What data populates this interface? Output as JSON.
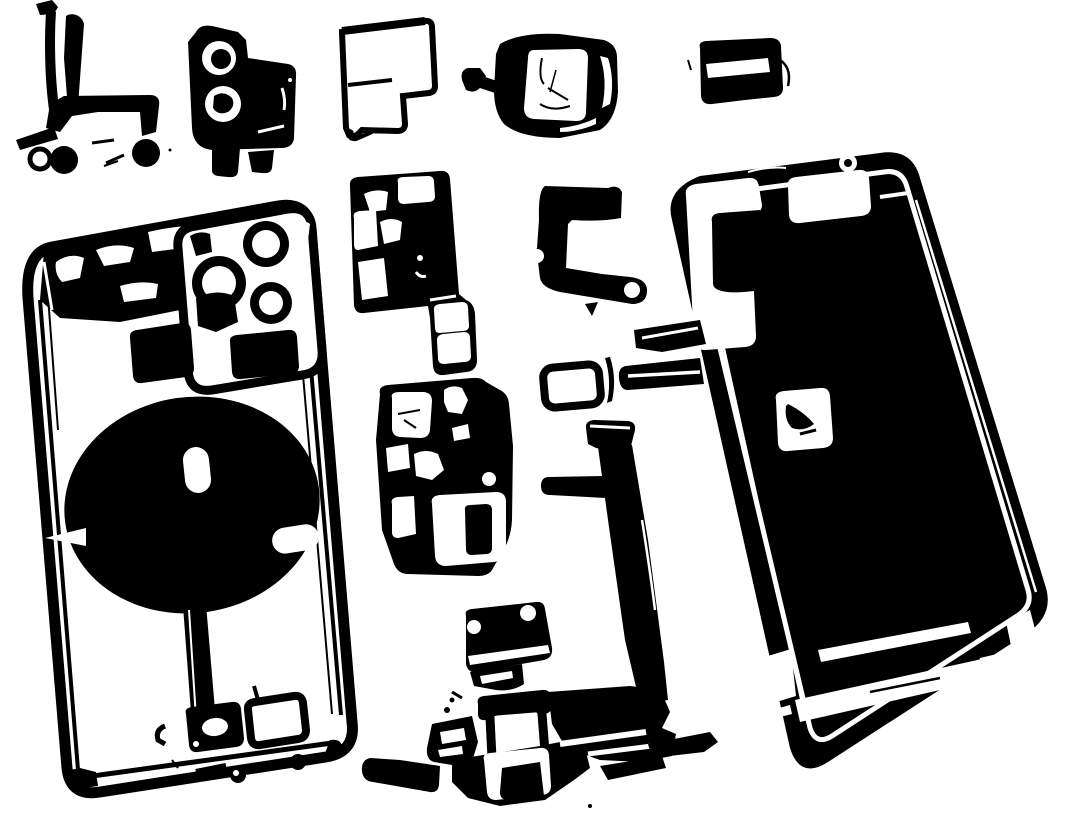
{
  "scene": {
    "type": "photo",
    "subject": "Disassembled smartphone teardown, parts laid out on white background",
    "style": "high-contrast black-and-white threshold stencil",
    "canvas": {
      "width": 1080,
      "height": 836
    },
    "palette": {
      "paper": "#ffffff",
      "ink": "#000000"
    },
    "parts": [
      {
        "id": "front-flex-cable-part",
        "label": "Flex cable with round grommets (top left)"
      },
      {
        "id": "camera-bracket-part",
        "label": "Camera bracket with two lens rings"
      },
      {
        "id": "corner-bracket-plate",
        "label": "Thin outlined corner bracket plate"
      },
      {
        "id": "rear-camera-module",
        "label": "Rear camera module block"
      },
      {
        "id": "slot-bracket-part",
        "label": "Small slotted bracket (top right)"
      },
      {
        "id": "mid-bracket-part",
        "label": "Shield bracket with windows"
      },
      {
        "id": "c-bracket-part",
        "label": "C-shaped bracket"
      },
      {
        "id": "sim-tray-frame",
        "label": "SIM tray frame outline"
      },
      {
        "id": "logic-board-part",
        "label": "Logic board with cutouts"
      },
      {
        "id": "display-flex-ribbon",
        "label": "Long display flex ribbon"
      },
      {
        "id": "speaker-module-part",
        "label": "Small speaker module with corner holes"
      },
      {
        "id": "charging-port-flex",
        "label": "Charging port flex assembly (bottom center)"
      },
      {
        "id": "back-housing",
        "label": "Rear housing with triple camera and wireless coil (left)"
      },
      {
        "id": "display-assembly",
        "label": "Display assembly, mostly dark interior (right)"
      }
    ]
  }
}
